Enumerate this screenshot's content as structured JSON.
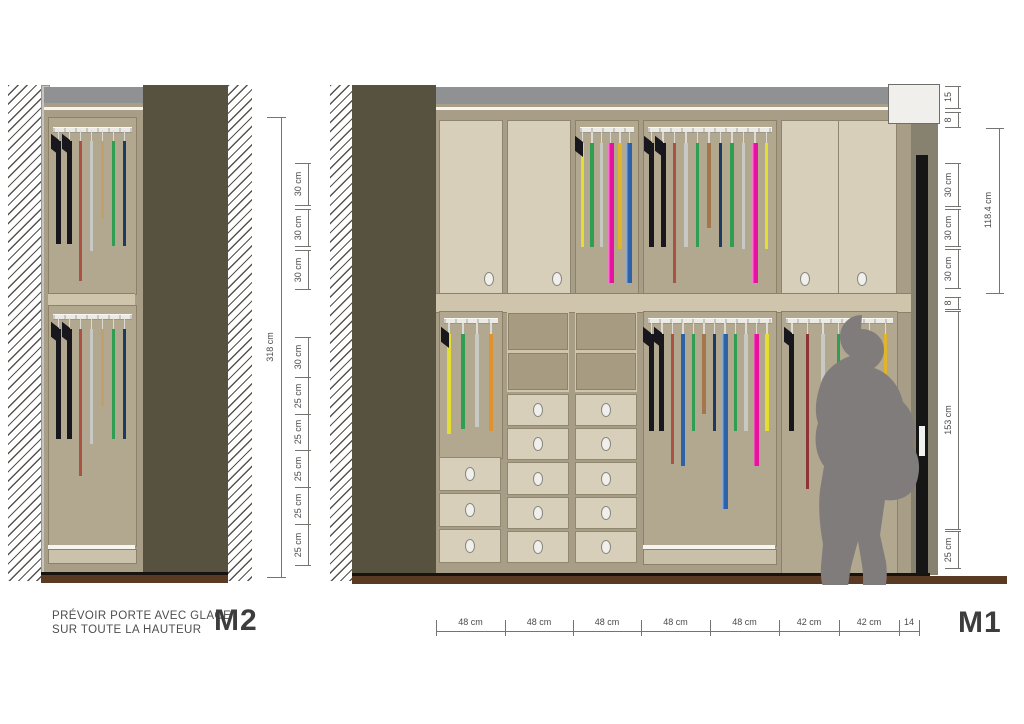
{
  "note": {
    "line1": "PRÉVOIR PORTE AVEC GLACE",
    "line2": "SUR TOUTE LA HAUTEUR"
  },
  "labels": {
    "m2": "M2",
    "m1": "M1"
  },
  "colors": {
    "garments": {
      "black": "#17171d",
      "rust": "#ac5244",
      "lightgray": "#c8c8c4",
      "green": "#2f9e53",
      "navy": "#1d3a63",
      "blue": "#2d62a8",
      "magenta": "#e812a0",
      "yellow": "#e4de33",
      "amber": "#e2b42c",
      "orange": "#e0922e",
      "brown": "#a5764a",
      "darkred": "#8e3434",
      "tan": "#c2a06c"
    },
    "accents": {
      "wall_panel": "#57513f",
      "top_band": "#8f9193",
      "carcass": "#a89d87",
      "interior": "#b2a78f",
      "door": "#d7cfba",
      "floor": "#5b3a24",
      "silhouette": "#807c7b",
      "dimension": "#4a4a4a"
    }
  },
  "m2": {
    "height_total": {
      "label": "318 cm"
    },
    "dims": [
      {
        "label": "30 cm",
        "px": 42
      },
      {
        "gap": 4
      },
      {
        "label": "30 cm",
        "px": 37
      },
      {
        "gap": 4
      },
      {
        "label": "30 cm",
        "px": 39
      },
      {
        "gap": 48
      },
      {
        "label": "30 cm",
        "px": 40
      },
      {
        "label": "25 cm",
        "px": 37
      },
      {
        "label": "25 cm",
        "px": 36
      },
      {
        "label": "25 cm",
        "px": 37
      },
      {
        "label": "25 cm",
        "px": 37
      },
      {
        "label": "25 cm",
        "px": 41
      }
    ],
    "upper_hangers": [
      {
        "c": "black",
        "h": 103,
        "t": "coat"
      },
      {
        "c": "black",
        "h": 103,
        "t": "coat"
      },
      {
        "c": "rust",
        "h": 140
      },
      {
        "c": "lightgray",
        "h": 110
      },
      {
        "c": "tan",
        "h": 78
      },
      {
        "c": "green",
        "h": 105
      },
      {
        "c": "navy",
        "h": 105
      }
    ],
    "lower_hangers": [
      {
        "c": "black",
        "h": 110,
        "t": "coat"
      },
      {
        "c": "black",
        "h": 110,
        "t": "coat"
      },
      {
        "c": "rust",
        "h": 147
      },
      {
        "c": "lightgray",
        "h": 115
      },
      {
        "c": "tan",
        "h": 78
      },
      {
        "c": "green",
        "h": 110
      },
      {
        "c": "navy",
        "h": 110
      }
    ]
  },
  "m1": {
    "outer_dim": {
      "label": "118.4 cm"
    },
    "right_dims": [
      {
        "label": "15",
        "px": 22
      },
      {
        "gap": 4
      },
      {
        "label": "8",
        "px": 15
      },
      {
        "gap": 36
      },
      {
        "label": "30 cm",
        "px": 43
      },
      {
        "gap": 3
      },
      {
        "label": "30 cm",
        "px": 37
      },
      {
        "gap": 3
      },
      {
        "label": "30 cm",
        "px": 39
      },
      {
        "gap": 9
      },
      {
        "label": "8",
        "px": 12
      },
      {
        "gap": 2
      },
      {
        "label": "153 cm",
        "px": 218
      },
      {
        "gap": 2
      },
      {
        "label": "25 cm",
        "px": 37
      }
    ],
    "bottom_dims": [
      {
        "label": "48 cm",
        "px": 69
      },
      {
        "label": "48 cm",
        "px": 68
      },
      {
        "label": "48 cm",
        "px": 68
      },
      {
        "label": "48 cm",
        "px": 69
      },
      {
        "label": "48 cm",
        "px": 69
      },
      {
        "label": "42 cm",
        "px": 60
      },
      {
        "label": "42 cm",
        "px": 60
      },
      {
        "label": "14",
        "px": 20
      }
    ],
    "sections": {
      "c3_upper": [
        {
          "c": "yellow",
          "h": 104,
          "flap": "black"
        },
        {
          "c": "green",
          "h": 104
        },
        {
          "c": "lightgray",
          "h": 104
        },
        {
          "c": "magenta",
          "h": 140,
          "t": "thick"
        },
        {
          "c": "amber",
          "h": 106
        },
        {
          "c": "blue",
          "h": 140,
          "t": "thick"
        }
      ],
      "c45_upper": [
        {
          "c": "black",
          "h": 104,
          "t": "coat"
        },
        {
          "c": "black",
          "h": 104,
          "t": "coat"
        },
        {
          "c": "rust",
          "h": 140
        },
        {
          "c": "lightgray",
          "h": 104
        },
        {
          "c": "green",
          "h": 104
        },
        {
          "c": "brown",
          "h": 85
        },
        {
          "c": "navy",
          "h": 104
        },
        {
          "c": "green",
          "h": 104
        },
        {
          "c": "lightgray",
          "h": 106
        },
        {
          "c": "magenta",
          "h": 140,
          "t": "thick"
        },
        {
          "c": "yellow",
          "h": 106
        }
      ],
      "c1_lower": [
        {
          "c": "yellow",
          "h": 100,
          "flap": "black"
        },
        {
          "c": "green",
          "h": 95
        },
        {
          "c": "lightgray",
          "h": 93
        },
        {
          "c": "orange",
          "h": 97
        }
      ],
      "c45_lower": [
        {
          "c": "black",
          "h": 97,
          "t": "coat"
        },
        {
          "c": "black",
          "h": 97,
          "t": "coat"
        },
        {
          "c": "rust",
          "h": 130
        },
        {
          "c": "blue",
          "h": 132
        },
        {
          "c": "green",
          "h": 97
        },
        {
          "c": "brown",
          "h": 80
        },
        {
          "c": "navy",
          "h": 97
        },
        {
          "c": "blue",
          "h": 175,
          "t": "thick"
        },
        {
          "c": "green",
          "h": 97
        },
        {
          "c": "lightgray",
          "h": 97
        },
        {
          "c": "magenta",
          "h": 132,
          "t": "thick"
        },
        {
          "c": "yellow",
          "h": 97
        }
      ],
      "c67_lower": [
        {
          "c": "black",
          "h": 97,
          "t": "coat"
        },
        {
          "c": "darkred",
          "h": 155
        },
        {
          "c": "lightgray",
          "h": 97
        },
        {
          "c": "green",
          "h": 97
        },
        {
          "c": "navy",
          "h": 97
        },
        {
          "c": "magenta",
          "h": 132,
          "t": "thick"
        },
        {
          "c": "amber",
          "h": 120
        }
      ]
    },
    "drawers": {
      "c1": 3,
      "c2": 5,
      "c3": 5
    },
    "cubbies": {
      "c2": 2,
      "c3": 2
    }
  }
}
